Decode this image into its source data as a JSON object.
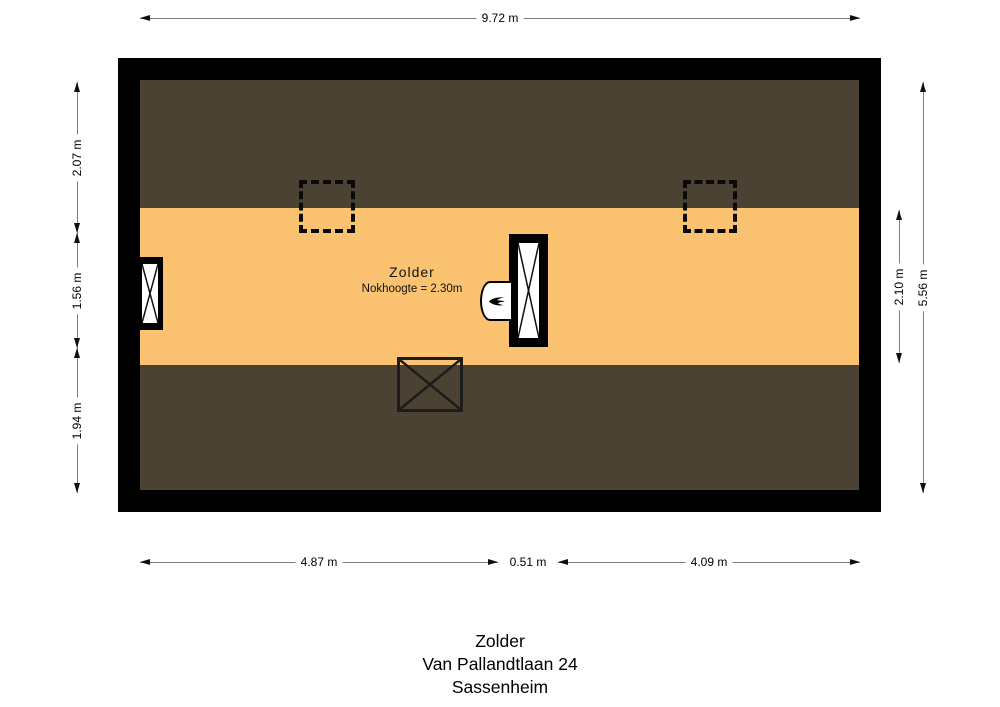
{
  "floorplan": {
    "room_label": "Zolder",
    "ridge_height": "Nokhoogte = 2.30m",
    "colors": {
      "floor": "#FBC271",
      "sloped_ceiling": "#4B4233",
      "wall": "#000000"
    },
    "icons": {
      "boiler": "flame-icon",
      "left_window": "window-cross-symbol",
      "center_window": "window-cross-symbol",
      "roof_windows": "dashed-roof-window-symbol",
      "floor_opening": "crossed-box-symbol"
    }
  },
  "dimensions": {
    "top": "9.72 m",
    "bottom": [
      "4.87 m",
      "0.51 m",
      "4.09 m"
    ],
    "left": [
      "2.07 m",
      "1.56 m",
      "1.94 m"
    ],
    "right": [
      "2.10 m",
      "5.56 m"
    ]
  },
  "caption": [
    "Zolder",
    "Van Pallandtlaan 24",
    "Sassenheim"
  ]
}
